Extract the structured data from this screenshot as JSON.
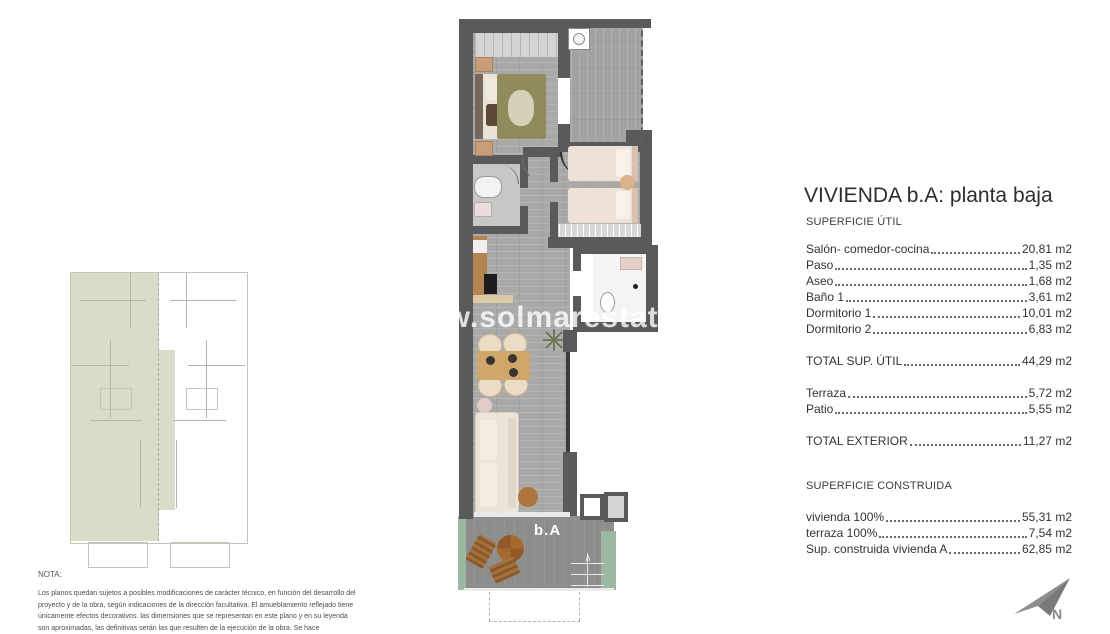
{
  "watermark": "www.solmarestates.com",
  "floor_plan": {
    "unit_label": "b.A"
  },
  "panel": {
    "title": "VIVIENDA b.A: planta baja",
    "section1_title": "SUPERFICIE ÚTIL",
    "util_rows": [
      {
        "label": "Salón- comedor-cocina",
        "value": "20,81 m2"
      },
      {
        "label": "Paso",
        "value": "1,35 m2"
      },
      {
        "label": "Aseo",
        "value": "1,68 m2"
      },
      {
        "label": "Baño 1",
        "value": "3,61 m2"
      },
      {
        "label": "Dormitorio 1",
        "value": "10,01 m2"
      },
      {
        "label": "Dormitorio 2",
        "value": "6,83 m2"
      }
    ],
    "total_util": {
      "label": "TOTAL SUP. ÚTIL",
      "value": "44,29 m2"
    },
    "exterior_rows": [
      {
        "label": "Terraza",
        "value": "5,72 m2"
      },
      {
        "label": "Patio",
        "value": "5,55 m2"
      }
    ],
    "total_exterior": {
      "label": "TOTAL EXTERIOR",
      "value": "11,27 m2"
    },
    "section2_title": "SUPERFICIE CONSTRUIDA",
    "construida_rows": [
      {
        "label": "vivienda 100%",
        "value": "55,31 m2"
      },
      {
        "label": "terraza 100%",
        "value": "7,54 m2"
      },
      {
        "label": "Sup. construida vivienda A",
        "value": "62,85 m2"
      }
    ]
  },
  "note": {
    "title": "NOTA:",
    "body": "Los planos quedan sujetos a posibles modificaciones de carácter técnico, en función del desarrollo del proyecto y de la obra, según indicaciones de la dirección facultativa. El amueblamiento reflejado tiene únicamente efectos decorativos. las dimensiones que se representan en este plano y en su leyenda son aproximadas, las definitivas serán las que resulten de la ejecución de la obra. Se hace"
  },
  "compass": {
    "label": "N"
  },
  "colors": {
    "wall": "#595a5c",
    "highlight_unit": "#dadcca",
    "hedge_green": "#9cb8a2"
  }
}
